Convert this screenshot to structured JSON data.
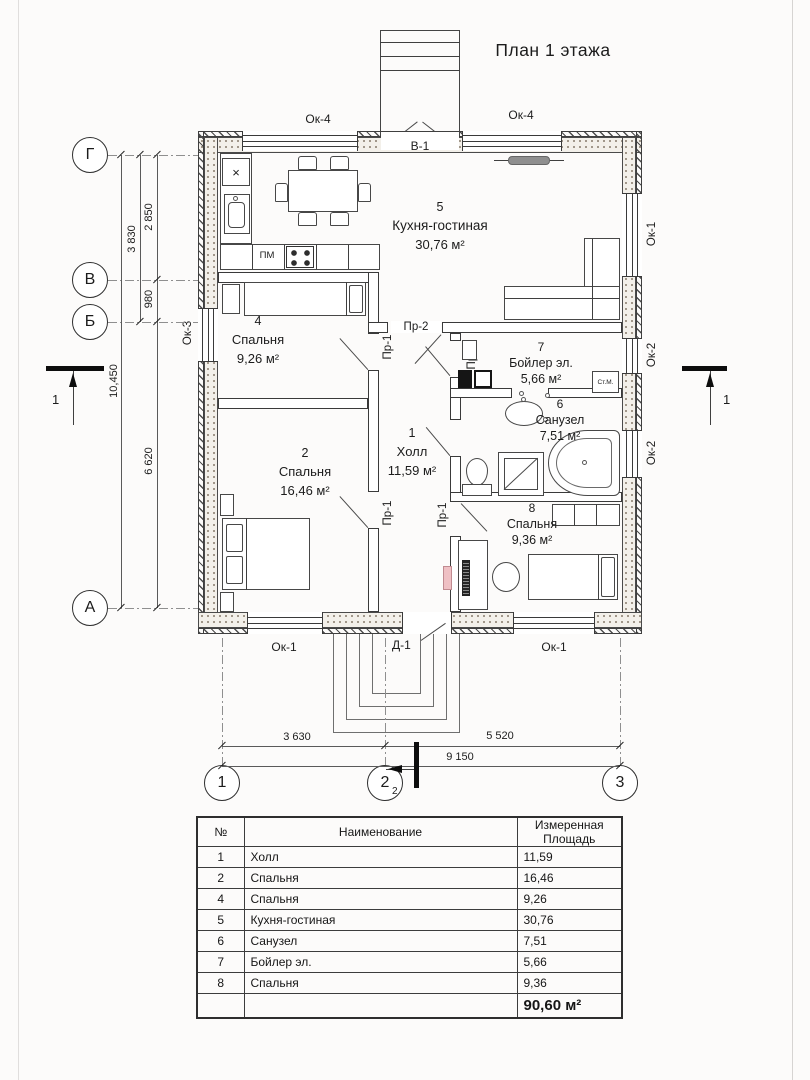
{
  "title": "План 1 этажа",
  "axes": {
    "left": [
      "Г",
      "В",
      "Б",
      "А"
    ],
    "bottom": [
      "1",
      "2",
      "3"
    ]
  },
  "dims": {
    "v_total": "10,450",
    "v_g_b": "3 830",
    "v_g_v": "2 850",
    "v_v_b": "980",
    "v_b_a": "6 620",
    "h_1_2": "3 630",
    "h_2_3": "5 520",
    "h_total": "9 150"
  },
  "openings": {
    "ok1": "Ок-1",
    "ok2": "Ок-2",
    "ok3": "Ок-3",
    "ok4": "Ок-4",
    "d1": "Д-1",
    "v1": "В-1",
    "pr1": "Пр-1",
    "pr2": "Пр-2",
    "pr3": "Пр-3"
  },
  "rooms": [
    {
      "num": "1",
      "name": "Холл",
      "area": "11,59 м²"
    },
    {
      "num": "2",
      "name": "Спальня",
      "area": "16,46 м²"
    },
    {
      "num": "4",
      "name": "Спальня",
      "area": "9,26 м²"
    },
    {
      "num": "5",
      "name": "Кухня-гостиная",
      "area": "30,76 м²"
    },
    {
      "num": "6",
      "name": "Санузел",
      "area": "7,51 м²"
    },
    {
      "num": "7",
      "name": "Бойлер эл.",
      "area": "5,66 м²"
    },
    {
      "num": "8",
      "name": "Спальня",
      "area": "9,36 м²"
    }
  ],
  "equipment": {
    "dishwasher": "ПМ",
    "washer": "Ст.М.",
    "fridge_mark": "×"
  },
  "sections": {
    "left": "1",
    "right": "1",
    "bottom": "2"
  },
  "table": {
    "headers": [
      "№",
      "Наименование",
      "Измеренная Площадь"
    ],
    "rows": [
      {
        "num": "1",
        "name": "Холл",
        "area": "11,59"
      },
      {
        "num": "2",
        "name": "Спальня",
        "area": "16,46"
      },
      {
        "num": "4",
        "name": "Спальня",
        "area": "9,26"
      },
      {
        "num": "5",
        "name": "Кухня-гостиная",
        "area": "30,76"
      },
      {
        "num": "6",
        "name": "Санузел",
        "area": "7,51"
      },
      {
        "num": "7",
        "name": "Бойлер эл.",
        "area": "5,66"
      },
      {
        "num": "8",
        "name": "Спальня",
        "area": "9,36"
      }
    ],
    "total": "90,60 м²"
  }
}
